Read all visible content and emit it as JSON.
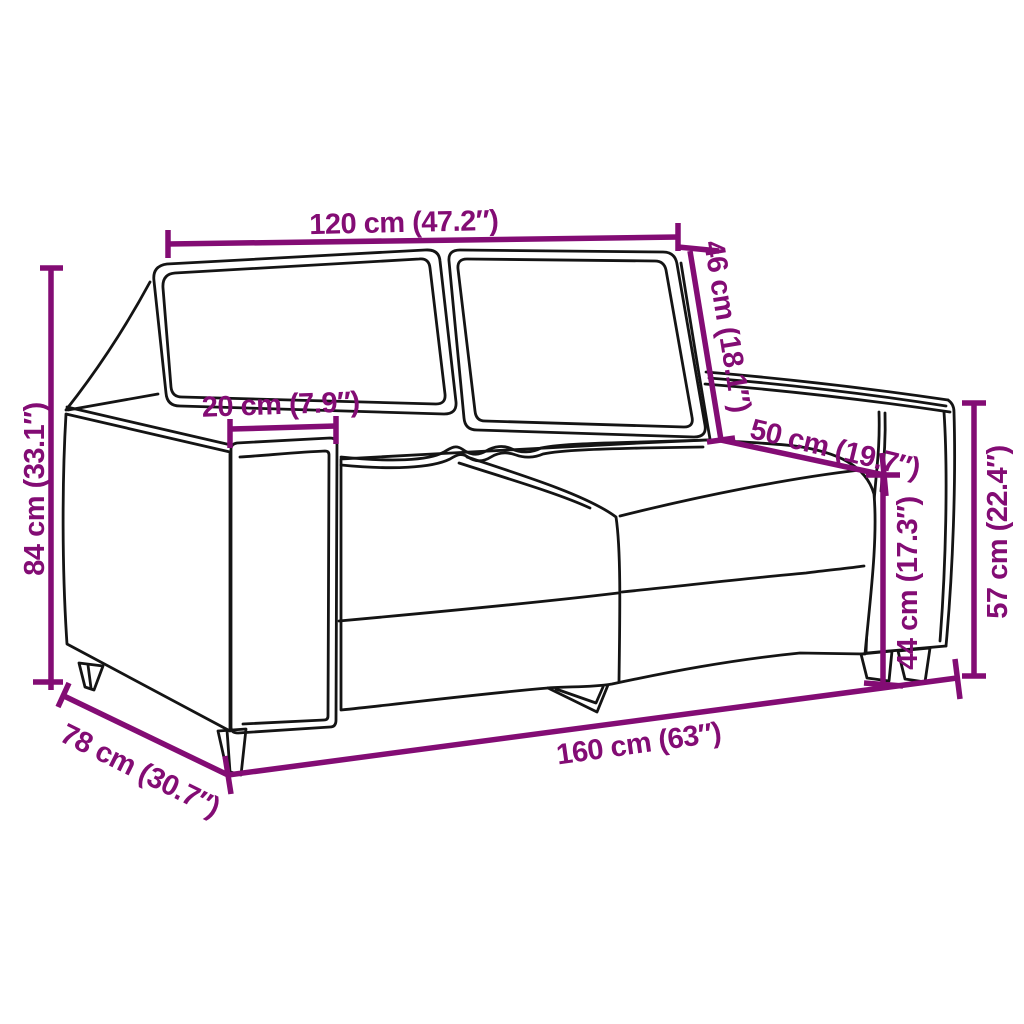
{
  "figure": {
    "subject": "2-seater sofa line drawing",
    "view": "front-left perspective product dimension diagram",
    "background": "#ffffff"
  },
  "palette": {
    "dimension_color": "#830C74",
    "outline_color": "#141414"
  },
  "dimensions": [
    {
      "id": "back-width",
      "label": "120 cm (47.2″)",
      "cm": 120,
      "inches": 47.2,
      "measures": "backrest / cushion width"
    },
    {
      "id": "backrest-height",
      "label": "46 cm (18.1″)",
      "cm": 46,
      "inches": 18.1,
      "measures": "backrest height"
    },
    {
      "id": "armrest-width",
      "label": "20 cm (7.9″)",
      "cm": 20,
      "inches": 7.9,
      "measures": "armrest width"
    },
    {
      "id": "seat-depth",
      "label": "50 cm (19.7″)",
      "cm": 50,
      "inches": 19.7,
      "measures": "seat depth"
    },
    {
      "id": "overall-height",
      "label": "84 cm (33.1″)",
      "cm": 84,
      "inches": 33.1,
      "measures": "overall height"
    },
    {
      "id": "seat-height",
      "label": "44 cm (17.3″)",
      "cm": 44,
      "inches": 17.3,
      "measures": "seat height from floor"
    },
    {
      "id": "armrest-height",
      "label": "57 cm (22.4″)",
      "cm": 57,
      "inches": 22.4,
      "measures": "armrest height from floor"
    },
    {
      "id": "overall-width",
      "label": "160 cm (63″)",
      "cm": 160,
      "inches": 63,
      "measures": "overall width"
    },
    {
      "id": "overall-depth",
      "label": "78 cm (30.7″)",
      "cm": 78,
      "inches": 30.7,
      "measures": "overall depth"
    }
  ]
}
